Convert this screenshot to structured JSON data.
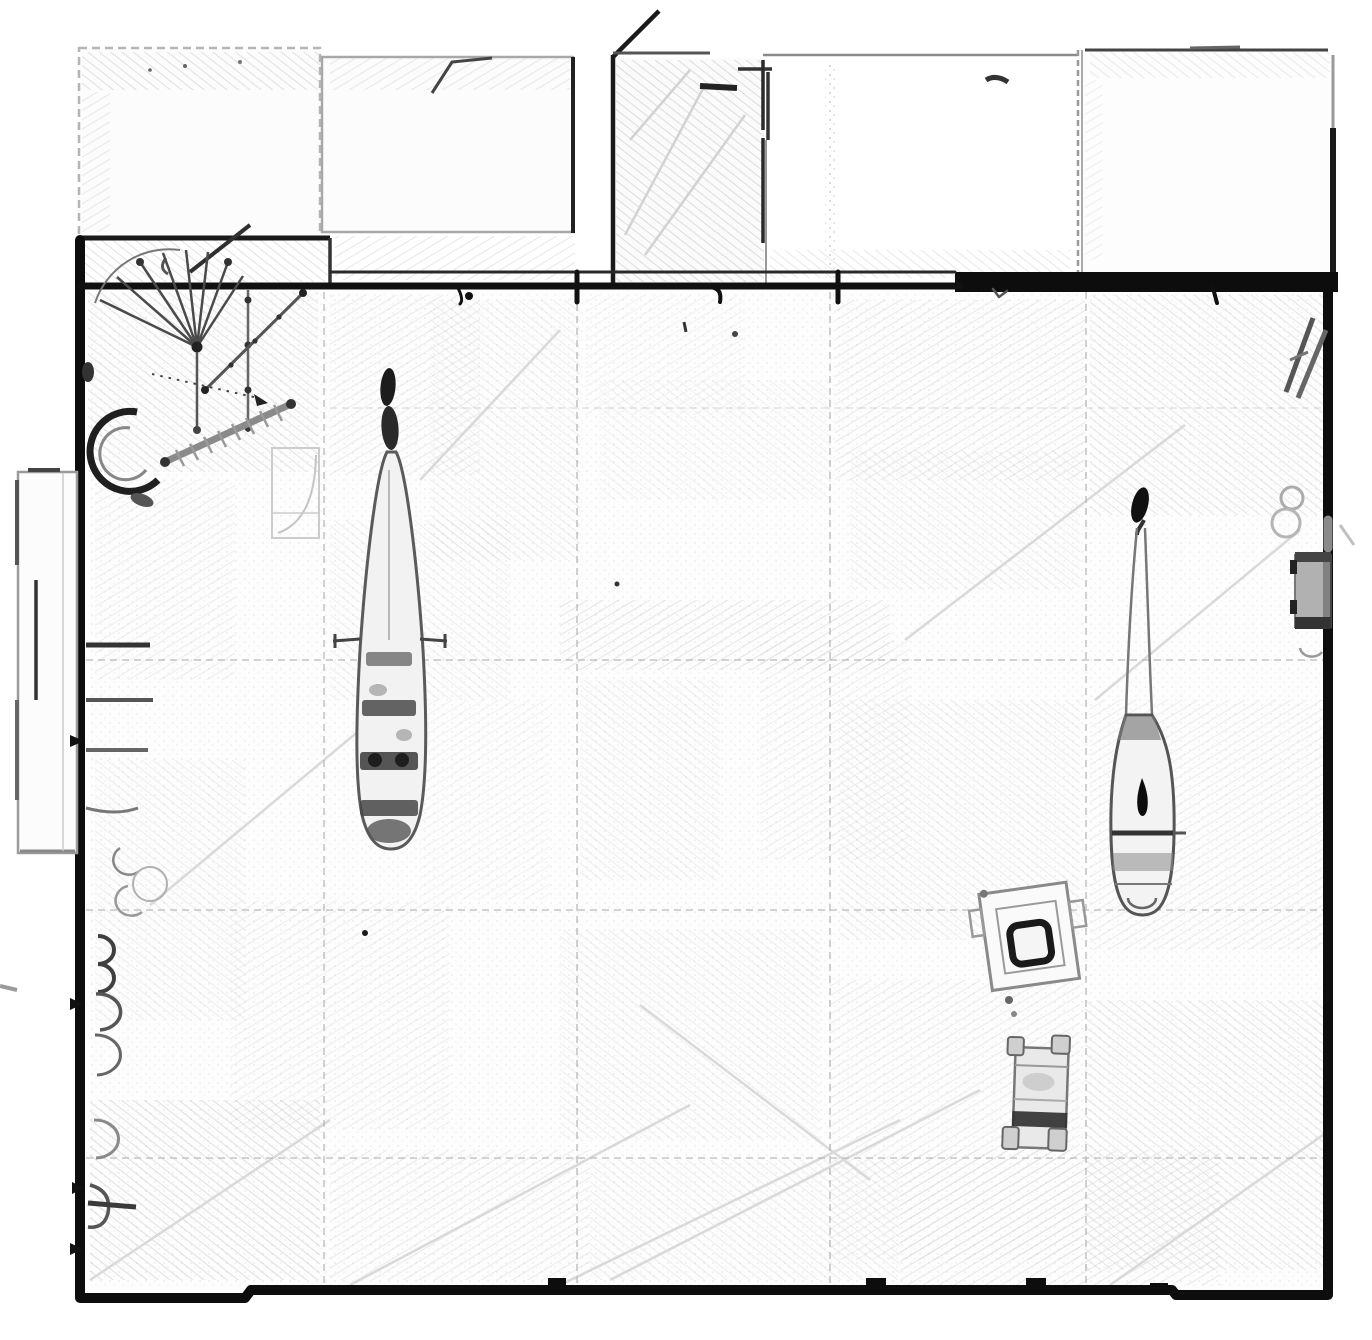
{
  "document": {
    "kind": "hand-drawn architectural floor plan (pencil sketch, no text labels)",
    "visible_text": ""
  },
  "colors": {
    "paper": "#ffffff",
    "hall_fill": "#fdfdfd",
    "ink": "#0d0d0d",
    "dark": "#2a2a2a",
    "mid": "#555555",
    "soft": "#8a8a8a",
    "faint": "#b3b3b3",
    "texture": "#cccccc",
    "streak": "#d9d9d9"
  },
  "features": {
    "hall": "main exhibition hall",
    "top_rooms": "row of rooms along top edge",
    "vestibule": "entrance vestibule with open door",
    "corridor": "corridor with door swing",
    "spiral_stair": "spiral staircase fan",
    "section_line": "dotted section line with arrow",
    "gangway": "toothed gangway ramp",
    "crescent": "curved wall / crescent feature",
    "left_annex": "annex bay on left wall",
    "wall_niches": "scalloped niches along left wall",
    "boat_large": "large boat hull, plan view",
    "boat_small": "small boat with curved prow, plan view",
    "display_case": "tilted display case with dark frame",
    "cart": "four-wheeled cart",
    "wall_bench": "bench block on right wall",
    "grid": "column grid lines of hall floor"
  }
}
